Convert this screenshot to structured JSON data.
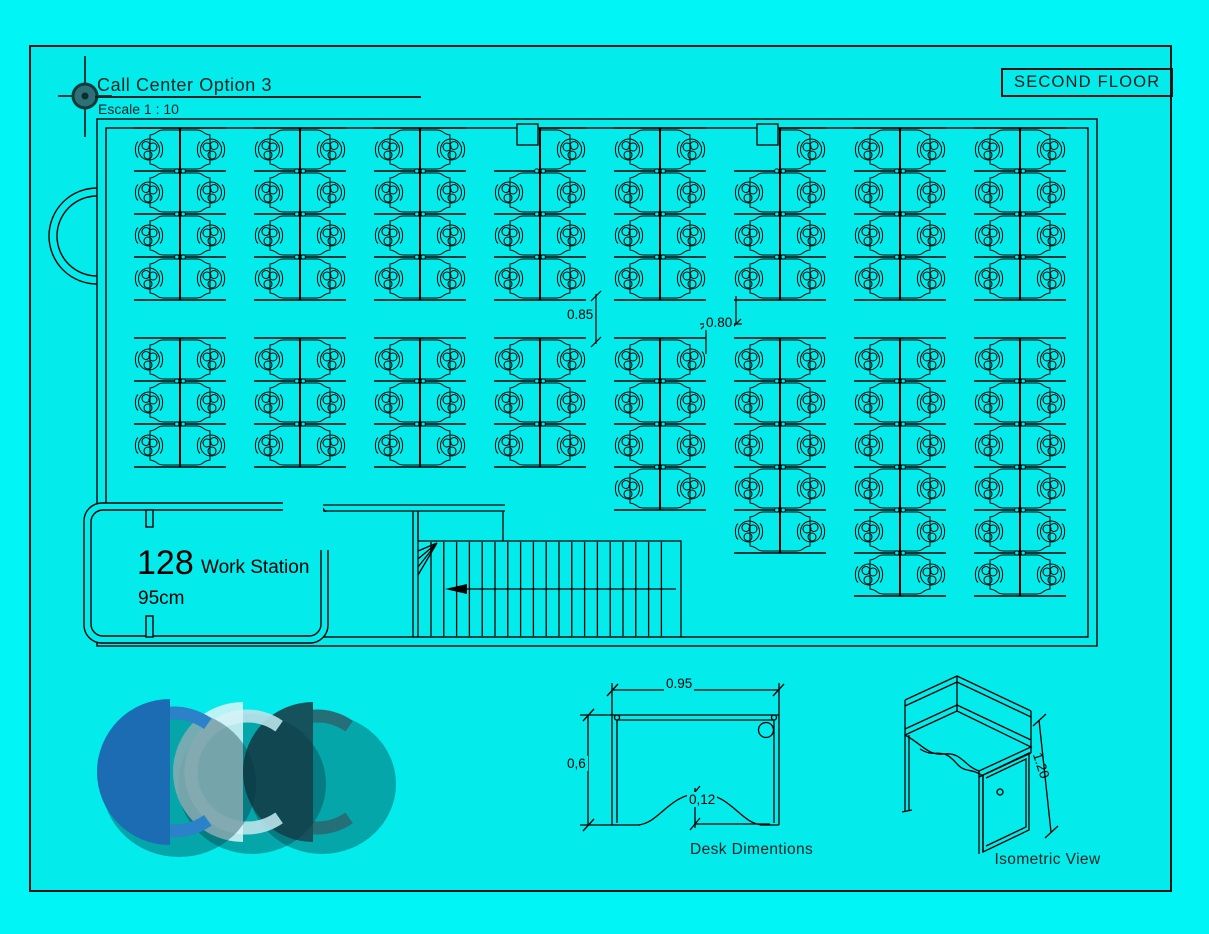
{
  "header": {
    "title": "Call Center Option 3",
    "subtitle": "Escale 1 : 10",
    "floor_label": "SECOND FLOOR"
  },
  "plan": {
    "workstation_count": "128",
    "workstation_label": "Work Station",
    "desk_width_label": "95cm",
    "aisle_vertical_dim": "0.85",
    "aisle_horizontal_dim": "0.80",
    "clusters": {
      "row_height": 43,
      "seat_span": 46,
      "top": {
        "y": 128,
        "spines": [
          180,
          300,
          420,
          540,
          660,
          780,
          900,
          1020
        ],
        "rows": [
          4,
          4,
          4,
          4,
          4,
          4,
          4,
          4
        ],
        "missing_seats": [
          [
            3,
            0,
            "left"
          ],
          [
            5,
            0,
            "left"
          ]
        ]
      },
      "bottom": {
        "y": 338,
        "spines": [
          180,
          300,
          420,
          540,
          660,
          780,
          900,
          1020
        ],
        "rows": [
          3,
          3,
          3,
          3,
          4,
          5,
          6,
          6
        ],
        "missing_seats": []
      },
      "wall_columns": [
        [
          517,
          124
        ],
        [
          757,
          124
        ]
      ]
    },
    "stairs": {
      "tread_count": 19
    }
  },
  "desk_diagram": {
    "width_dim": "0.95",
    "depth_dim": "0,6",
    "cutout_dim": "0,12",
    "caption": "Desk Dimentions"
  },
  "isometric": {
    "height_dim": "1.20",
    "caption": "Isometric View"
  },
  "logo": {
    "glyphs": [
      {
        "cx": 170,
        "cy": 772,
        "r": 73,
        "main": "#1c6cb4",
        "ring": "#2c82c8"
      },
      {
        "cx": 243,
        "cy": 772,
        "r": 70,
        "main": "rgba(216,244,248,0.85)",
        "ring": "rgba(186,227,234,0.9)"
      },
      {
        "cx": 313,
        "cy": 772,
        "r": 70,
        "main": "#16525b",
        "ring": "#257078"
      }
    ],
    "shadow": "rgba(8,54,66,0.38)"
  }
}
